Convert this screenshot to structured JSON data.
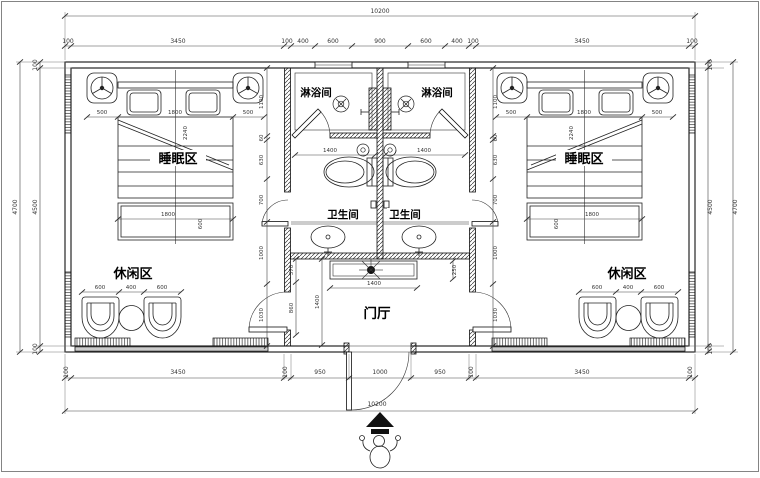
{
  "plan": {
    "labels": {
      "sleep": "睡眠区",
      "leisure": "休闲区",
      "shower": "淋浴间",
      "wc": "卫生间",
      "hall": "门厅"
    },
    "dims": {
      "top_total": "10200",
      "bottom_total": "10200",
      "top_chain": [
        "100",
        "3450",
        "100",
        "400",
        "600",
        "900",
        "600",
        "400",
        "100",
        "3450",
        "100"
      ],
      "bottom_chain": [
        "100",
        "3450",
        "100",
        "950",
        "1000",
        "950",
        "100",
        "3450",
        "100"
      ],
      "side": {
        "outer": "4700",
        "inner": "4500",
        "top": "100",
        "bottom": "100"
      },
      "room_chain": [
        "1100",
        "60",
        "630",
        "700",
        "1000",
        "1030"
      ],
      "bed": {
        "side": "500",
        "width": "1800",
        "length": "2240",
        "bench_width": "1800",
        "bench_depth": "600"
      },
      "leisure_chain": [
        "600",
        "400",
        "600"
      ],
      "shower_width": "1400",
      "hall": {
        "seg_a": "370",
        "seg_b": "860",
        "depth": "1400",
        "console_width": "1400",
        "console_depth": "250"
      }
    },
    "icons": [
      "ceiling-light-icon",
      "floor-drain-icon",
      "toilet-icon",
      "toilet-paper-icon",
      "wash-basin-icon",
      "armchair-icon",
      "tea-table-icon",
      "double-bed-icon",
      "plant-decor-icon",
      "entry-arrow-icon",
      "person-icon"
    ]
  }
}
